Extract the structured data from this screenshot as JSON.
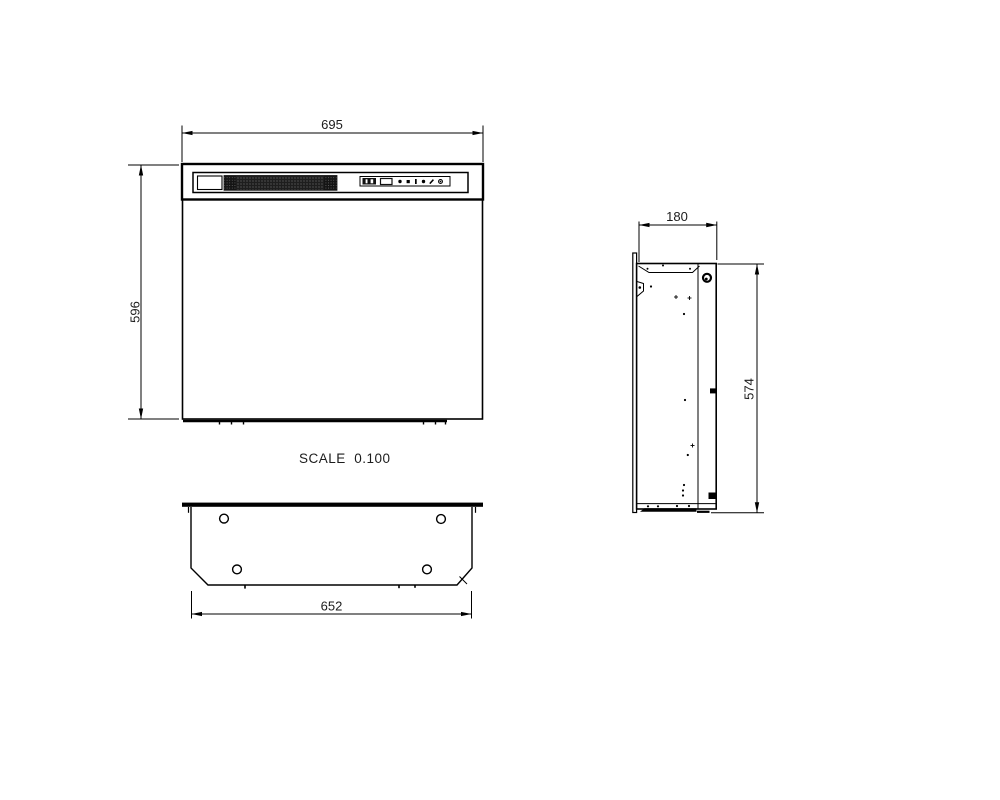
{
  "drawing": {
    "scale_label": "SCALE  0.100",
    "dimensions": {
      "front_width": "695",
      "front_height": "596",
      "side_depth": "180",
      "side_height": "574",
      "bottom_width": "652"
    },
    "views": {
      "front": "front elevation of fireplace insert with top grille and control panel",
      "side": "right side section showing mounting flange and cabinet depth",
      "bottom": "bottom view with four mounting holes and chamfered corners"
    },
    "control_panel": {
      "icons": [
        "digit-display",
        "rocker-button",
        "dot-button",
        "square-button",
        "bar-button",
        "dot-button",
        "slash-button",
        "ring-button"
      ]
    },
    "colors": {
      "background": "#ffffff",
      "line": "#000000",
      "text": "#1c1c1c",
      "grille_dark": "#1e1e1e"
    }
  }
}
